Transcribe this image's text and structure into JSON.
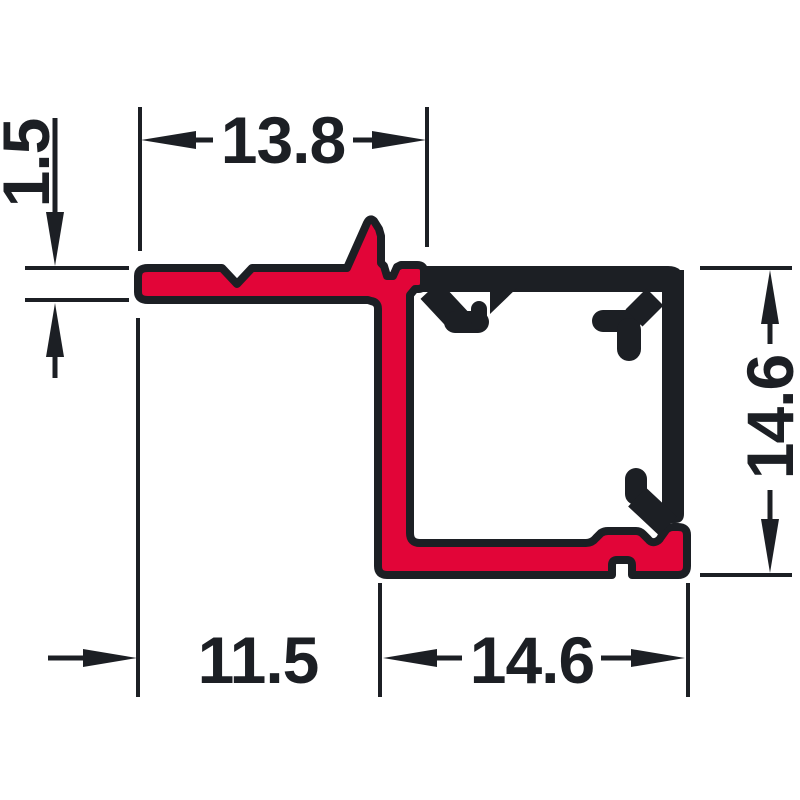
{
  "title": "Aluminium profile cross-section drawing",
  "colors": {
    "profile_red": "#e20538",
    "line_black": "#1c1f24",
    "background": "#ffffff"
  },
  "dimensions": {
    "arm_thickness": {
      "label": "1.5"
    },
    "top_width": {
      "label": "13.8"
    },
    "frame_height": {
      "label": "14.6"
    },
    "bottom_left_width": {
      "label": "11.5"
    },
    "bottom_right_width": {
      "label": "14.6"
    }
  }
}
